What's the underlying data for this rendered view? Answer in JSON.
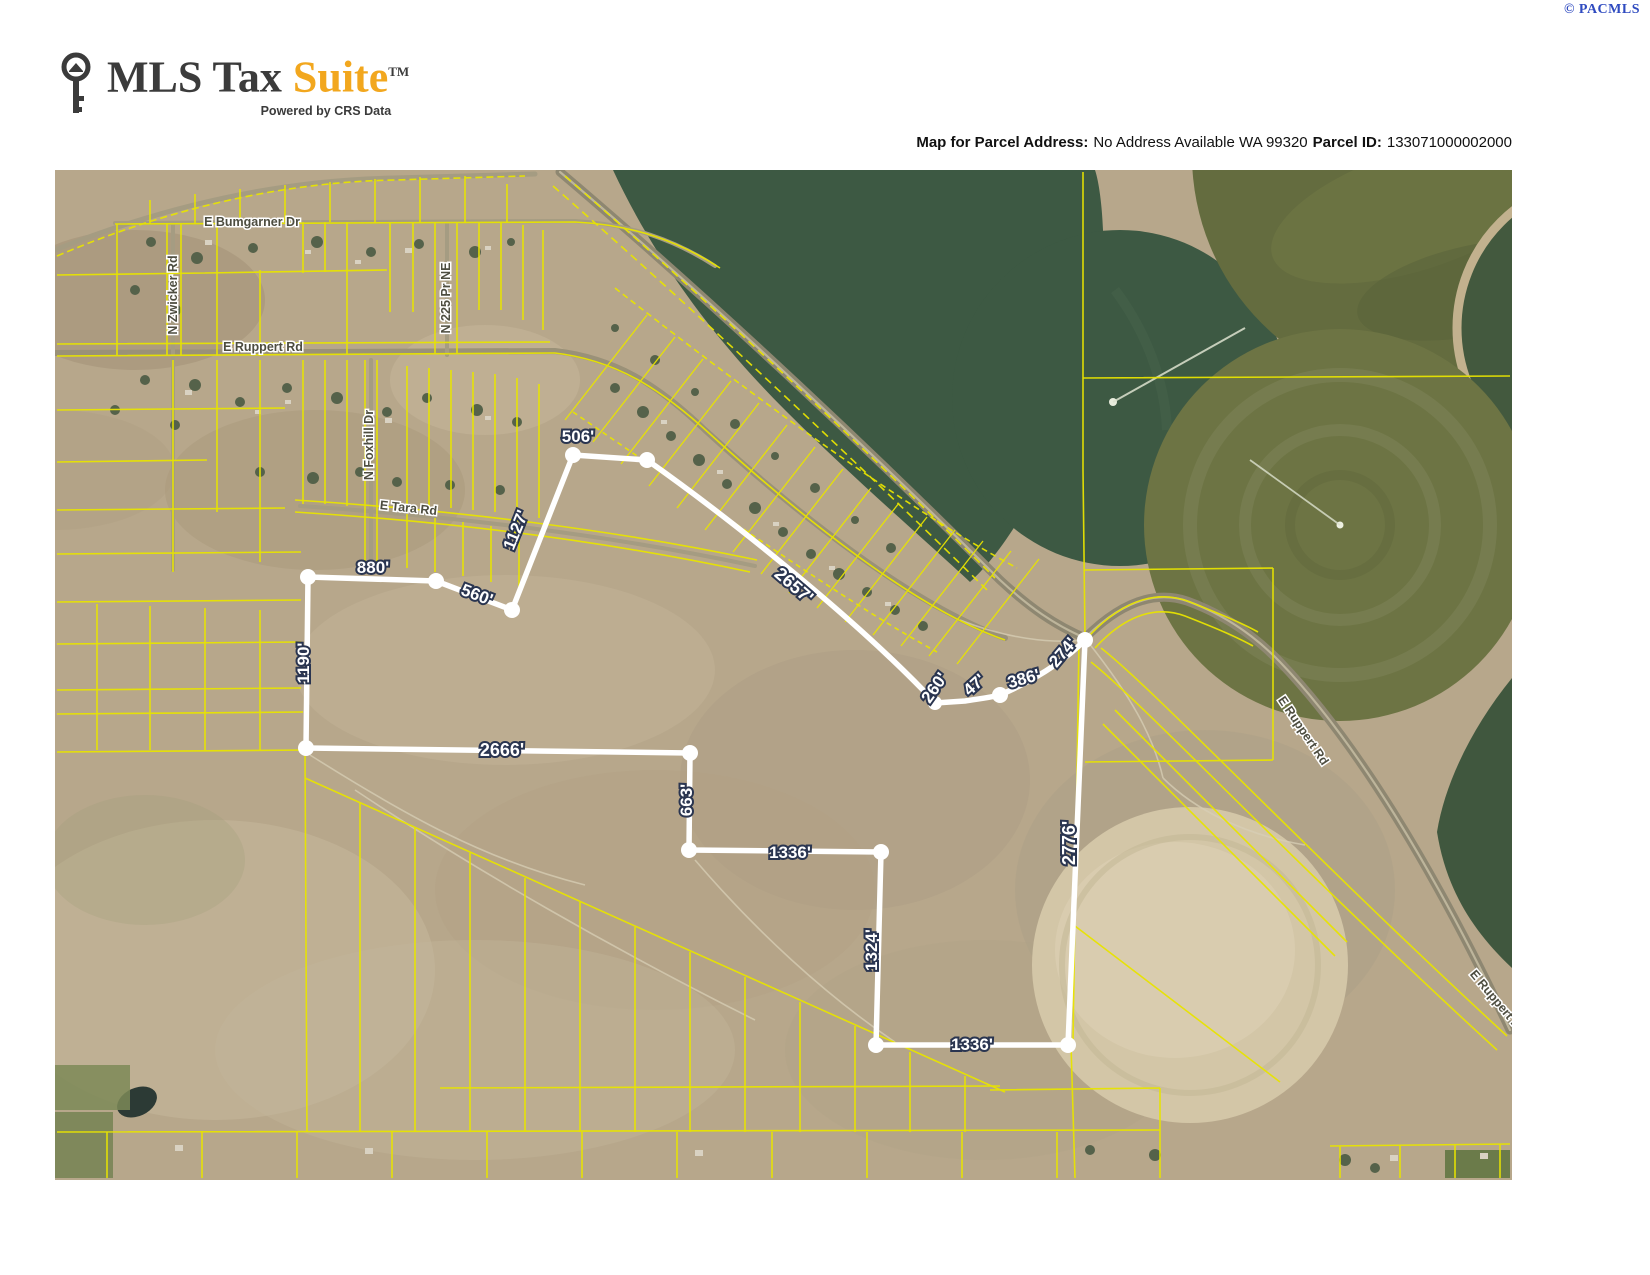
{
  "attribution": {
    "copyright": "© PACMLS"
  },
  "logo": {
    "title_dark": "MLS Tax ",
    "title_accent": "Suite",
    "tm": "TM",
    "tagline": "Powered by CRS Data"
  },
  "header": {
    "address_label": "Map for Parcel Address:",
    "address_value": "No Address Available WA 99320",
    "parcel_label": "Parcel ID:",
    "parcel_value": "133071000002000"
  },
  "map": {
    "streets": [
      {
        "name": "E Bumgarner Dr"
      },
      {
        "name": "N Zwicker Rd"
      },
      {
        "name": "N 225 Pr NE"
      },
      {
        "name": "E Ruppert Rd"
      },
      {
        "name": "N Foxhill Dr"
      },
      {
        "name": "E Tara Rd"
      },
      {
        "name": "E Ruppert Rd"
      },
      {
        "name": "E Ruppert Rd"
      }
    ],
    "dimensions": [
      {
        "label": "506'"
      },
      {
        "label": "1127'"
      },
      {
        "label": "880'"
      },
      {
        "label": "560'"
      },
      {
        "label": "2657'"
      },
      {
        "label": "260'"
      },
      {
        "label": "47'"
      },
      {
        "label": "386'"
      },
      {
        "label": "274'"
      },
      {
        "label": "2776'"
      },
      {
        "label": "1190'"
      },
      {
        "label": "2666'"
      },
      {
        "label": "663'"
      },
      {
        "label": "1336'"
      },
      {
        "label": "1324'"
      },
      {
        "label": "1336'"
      }
    ],
    "colors": {
      "parcel_line": "#ffffff",
      "lot_line": "#e8e400",
      "field_dark_green": "#3d5943",
      "field_olive": "#646c3f",
      "fallow_circle": "#d3c6a7",
      "terrain": "#b7a78b"
    }
  }
}
